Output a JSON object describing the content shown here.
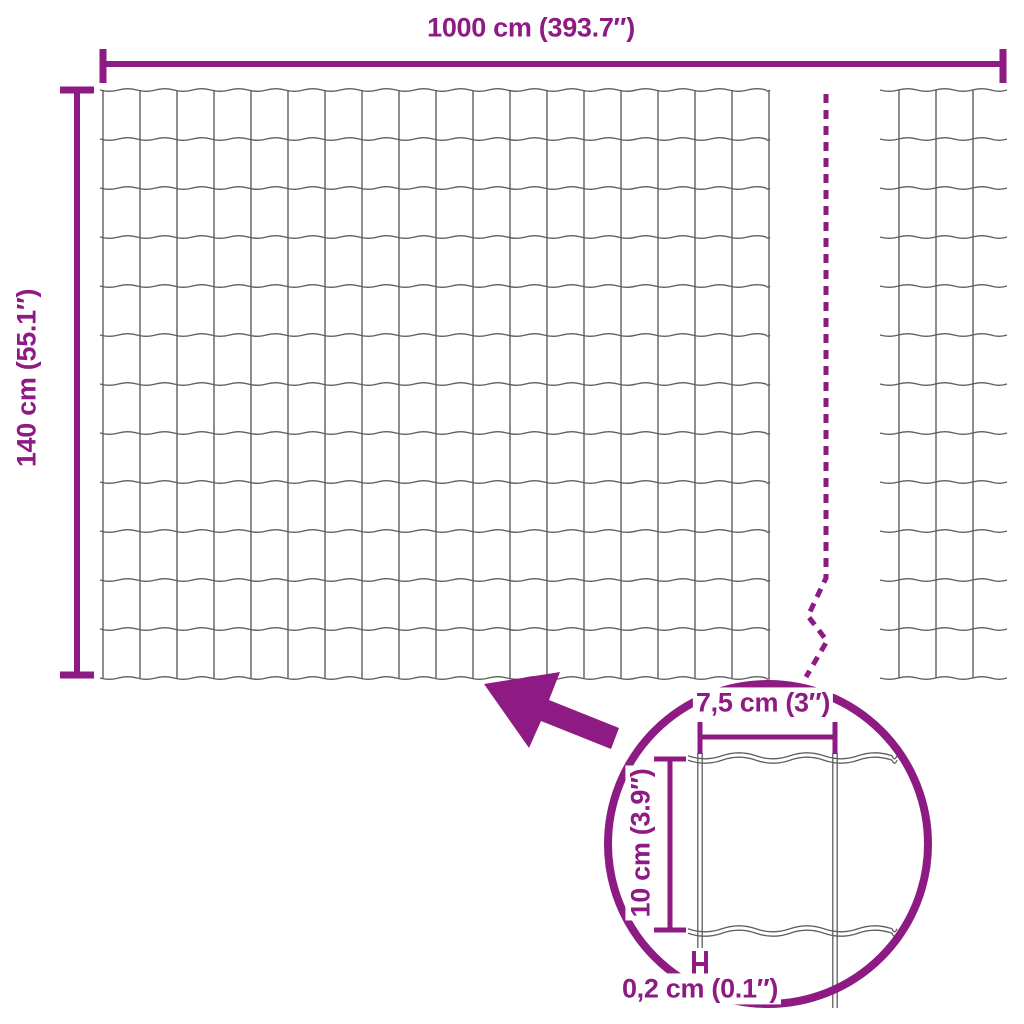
{
  "diagram": {
    "total_width_label": "1000 cm (393.7″)",
    "total_height_label": "140 cm (55.1″)",
    "detail": {
      "cell_width_label": "7,5 cm (3″)",
      "cell_height_label": "10 cm (3.9″)",
      "wire_thickness_label": "0,2 cm (0.1″)"
    },
    "icons": {
      "magnifier_circle": "zoom-detail-circle",
      "pointer_arrow": "detail-pointer-arrow",
      "break_line": "length-break-dashed-line"
    },
    "colors": {
      "accent": "#8E1A84",
      "wire": "#5E5E5E",
      "background": "#FFFFFF"
    }
  }
}
